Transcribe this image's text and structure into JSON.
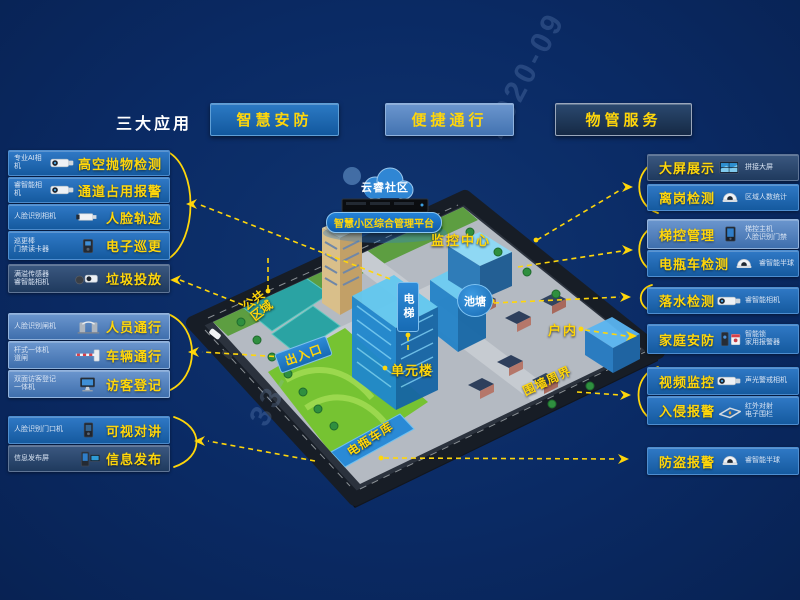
{
  "header": {
    "title": "三大应用",
    "apps": [
      {
        "id": "security",
        "label": "智慧安防",
        "color": "#1b63ae"
      },
      {
        "id": "access",
        "label": "便捷通行",
        "color": "#4a7fc0"
      },
      {
        "id": "property",
        "label": "物管服务",
        "color": "#1d3a5f"
      }
    ]
  },
  "left_items": [
    {
      "device": "专业AI相机",
      "label": "高空抛物检测",
      "theme": "security",
      "icon": "bullet-camera"
    },
    {
      "device": "睿智能相机",
      "label": "通道占用报警",
      "theme": "security",
      "icon": "bullet-camera"
    },
    {
      "device": "人脸识别相机",
      "label": "人脸轨迹",
      "theme": "security",
      "icon": "box-camera"
    },
    {
      "device": "巡更棒\n门禁读卡器",
      "label": "电子巡更",
      "theme": "security",
      "icon": "card-reader"
    },
    {
      "device": "满溢传感器\n睿智能相机",
      "label": "垃圾投放",
      "theme": "property",
      "icon": "sensor-camera"
    },
    {
      "device": "人脸识别闸机",
      "label": "人员通行",
      "theme": "access",
      "icon": "turnstile"
    },
    {
      "device": "杆式一体机\n道闸",
      "label": "车辆通行",
      "theme": "access",
      "icon": "barrier-gate"
    },
    {
      "device": "双面访客登记\n一体机",
      "label": "访客登记",
      "theme": "access",
      "icon": "visitor-kiosk"
    },
    {
      "device": "人脸识别门口机",
      "label": "可视对讲",
      "theme": "security",
      "icon": "door-station"
    },
    {
      "device": "信息发布屏",
      "label": "信息发布",
      "theme": "property",
      "icon": "signage-screen"
    }
  ],
  "right_items": [
    {
      "label": "大屏展示",
      "device": "拼接大屏",
      "theme": "property",
      "icon": "video-wall"
    },
    {
      "label": "离岗检测",
      "device": "区域人数统计",
      "theme": "security",
      "icon": "dome-camera"
    },
    {
      "label": "梯控管理",
      "device": "梯控主机\n人脸识别门禁",
      "theme": "access",
      "icon": "elevator-panel"
    },
    {
      "label": "电瓶车检测",
      "device": "睿智能半球",
      "theme": "security",
      "icon": "dome-camera"
    },
    {
      "label": "落水检测",
      "device": "睿智能相机",
      "theme": "security",
      "icon": "bullet-camera"
    },
    {
      "label": "家庭安防",
      "device": "智能锁\n家用报警器",
      "theme": "security",
      "icon": "lock-alarm"
    },
    {
      "label": "视频监控",
      "device": "声光警戒相机",
      "theme": "security",
      "icon": "bullet-camera"
    },
    {
      "label": "入侵报警",
      "device": "红外对射\n电子围栏",
      "theme": "security",
      "icon": "fence-perimeter"
    },
    {
      "label": "防盗报警",
      "device": "睿智能半球",
      "theme": "security",
      "icon": "dome-camera"
    }
  ],
  "map": {
    "cloud_label": "云睿社区",
    "platform_label": "智慧小区综合管理平台",
    "labels": {
      "monitor_center": "监控中心",
      "elevator": "电梯",
      "pond": "池塘",
      "public_area": "公共区域",
      "entrance": "出入口",
      "unit_building": "单元楼",
      "indoor": "户内",
      "perimeter": "围墙周界",
      "bike_garage": "电瓶车库"
    }
  },
  "watermarks": {
    "fragment_1": "2020-09",
    "fragment_2": "33-"
  },
  "colors": {
    "background": "#0a2a64",
    "accent_yellow": "#ffd60a",
    "security_blue": "#1b63ae",
    "access_blue": "#4a7fc0",
    "property_navy": "#1d3a5f"
  }
}
